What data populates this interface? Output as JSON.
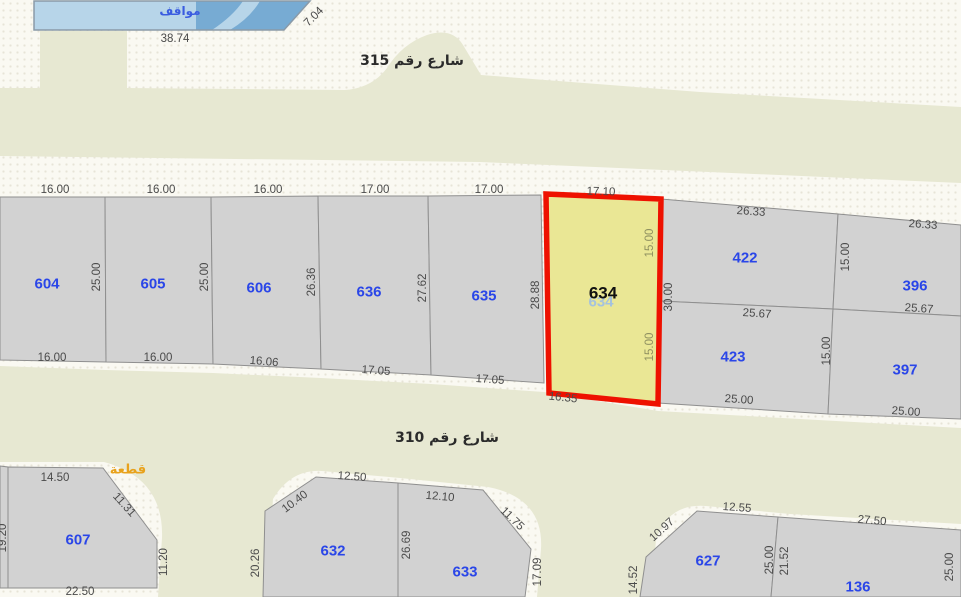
{
  "map": {
    "colors": {
      "background": "#faf9f2",
      "street": "#e7e8d2",
      "parcel_fill": "#d2d2d2",
      "parcel_stroke": "#8f8f8f",
      "selected_fill": "#eae795",
      "selected_border": "#ee1100",
      "parcel_number": "#2a46e8",
      "dimension_text": "#4a4a4a",
      "parking_light": "#b7d5e9",
      "parking_dark": "#77abd3",
      "annotation_orange": "#e8a21c"
    },
    "streets": [
      {
        "name": "street-315",
        "label": "شارع رقم 315"
      },
      {
        "name": "street-310",
        "label": "شارع رقم 310"
      }
    ],
    "parking": {
      "label": "مواقف"
    },
    "annotation": {
      "label": "قطعة"
    },
    "selected_parcel": {
      "number": "634",
      "ghost_number": "634"
    },
    "parcels": [
      {
        "number": "604"
      },
      {
        "number": "605"
      },
      {
        "number": "606"
      },
      {
        "number": "636"
      },
      {
        "number": "635"
      },
      {
        "number": "422"
      },
      {
        "number": "396"
      },
      {
        "number": "423"
      },
      {
        "number": "397"
      },
      {
        "number": "607"
      },
      {
        "number": "632"
      },
      {
        "number": "633"
      },
      {
        "number": "627"
      },
      {
        "number": "136"
      }
    ],
    "dimensions": [
      {
        "text": "38.74"
      },
      {
        "text": "7.04"
      },
      {
        "text": "16.00"
      },
      {
        "text": "16.00"
      },
      {
        "text": "16.00"
      },
      {
        "text": "17.00"
      },
      {
        "text": "17.00"
      },
      {
        "text": "17.10"
      },
      {
        "text": "26.33"
      },
      {
        "text": "26.33"
      },
      {
        "text": "25.00"
      },
      {
        "text": "25.00"
      },
      {
        "text": "26.36"
      },
      {
        "text": "27.62"
      },
      {
        "text": "28.88"
      },
      {
        "text": "15.00"
      },
      {
        "text": "15.00"
      },
      {
        "text": "30.00"
      },
      {
        "text": "15.00"
      },
      {
        "text": "15.00"
      },
      {
        "text": "25.67"
      },
      {
        "text": "25.67"
      },
      {
        "text": "25.00"
      },
      {
        "text": "25.00"
      },
      {
        "text": "16.00"
      },
      {
        "text": "16.00"
      },
      {
        "text": "16.06"
      },
      {
        "text": "17.05"
      },
      {
        "text": "17.05"
      },
      {
        "text": "16.35"
      },
      {
        "text": "14.50"
      },
      {
        "text": "11.31"
      },
      {
        "text": "11.20"
      },
      {
        "text": "22.50"
      },
      {
        "text": "19.20"
      },
      {
        "text": "12.50"
      },
      {
        "text": "10.40"
      },
      {
        "text": "20.26"
      },
      {
        "text": "26.69"
      },
      {
        "text": "12.10"
      },
      {
        "text": "11.75"
      },
      {
        "text": "17.09"
      },
      {
        "text": "10.97"
      },
      {
        "text": "14.52"
      },
      {
        "text": "12.55"
      },
      {
        "text": "25.00"
      },
      {
        "text": "21.52"
      },
      {
        "text": "27.50"
      },
      {
        "text": "25.00"
      }
    ]
  }
}
